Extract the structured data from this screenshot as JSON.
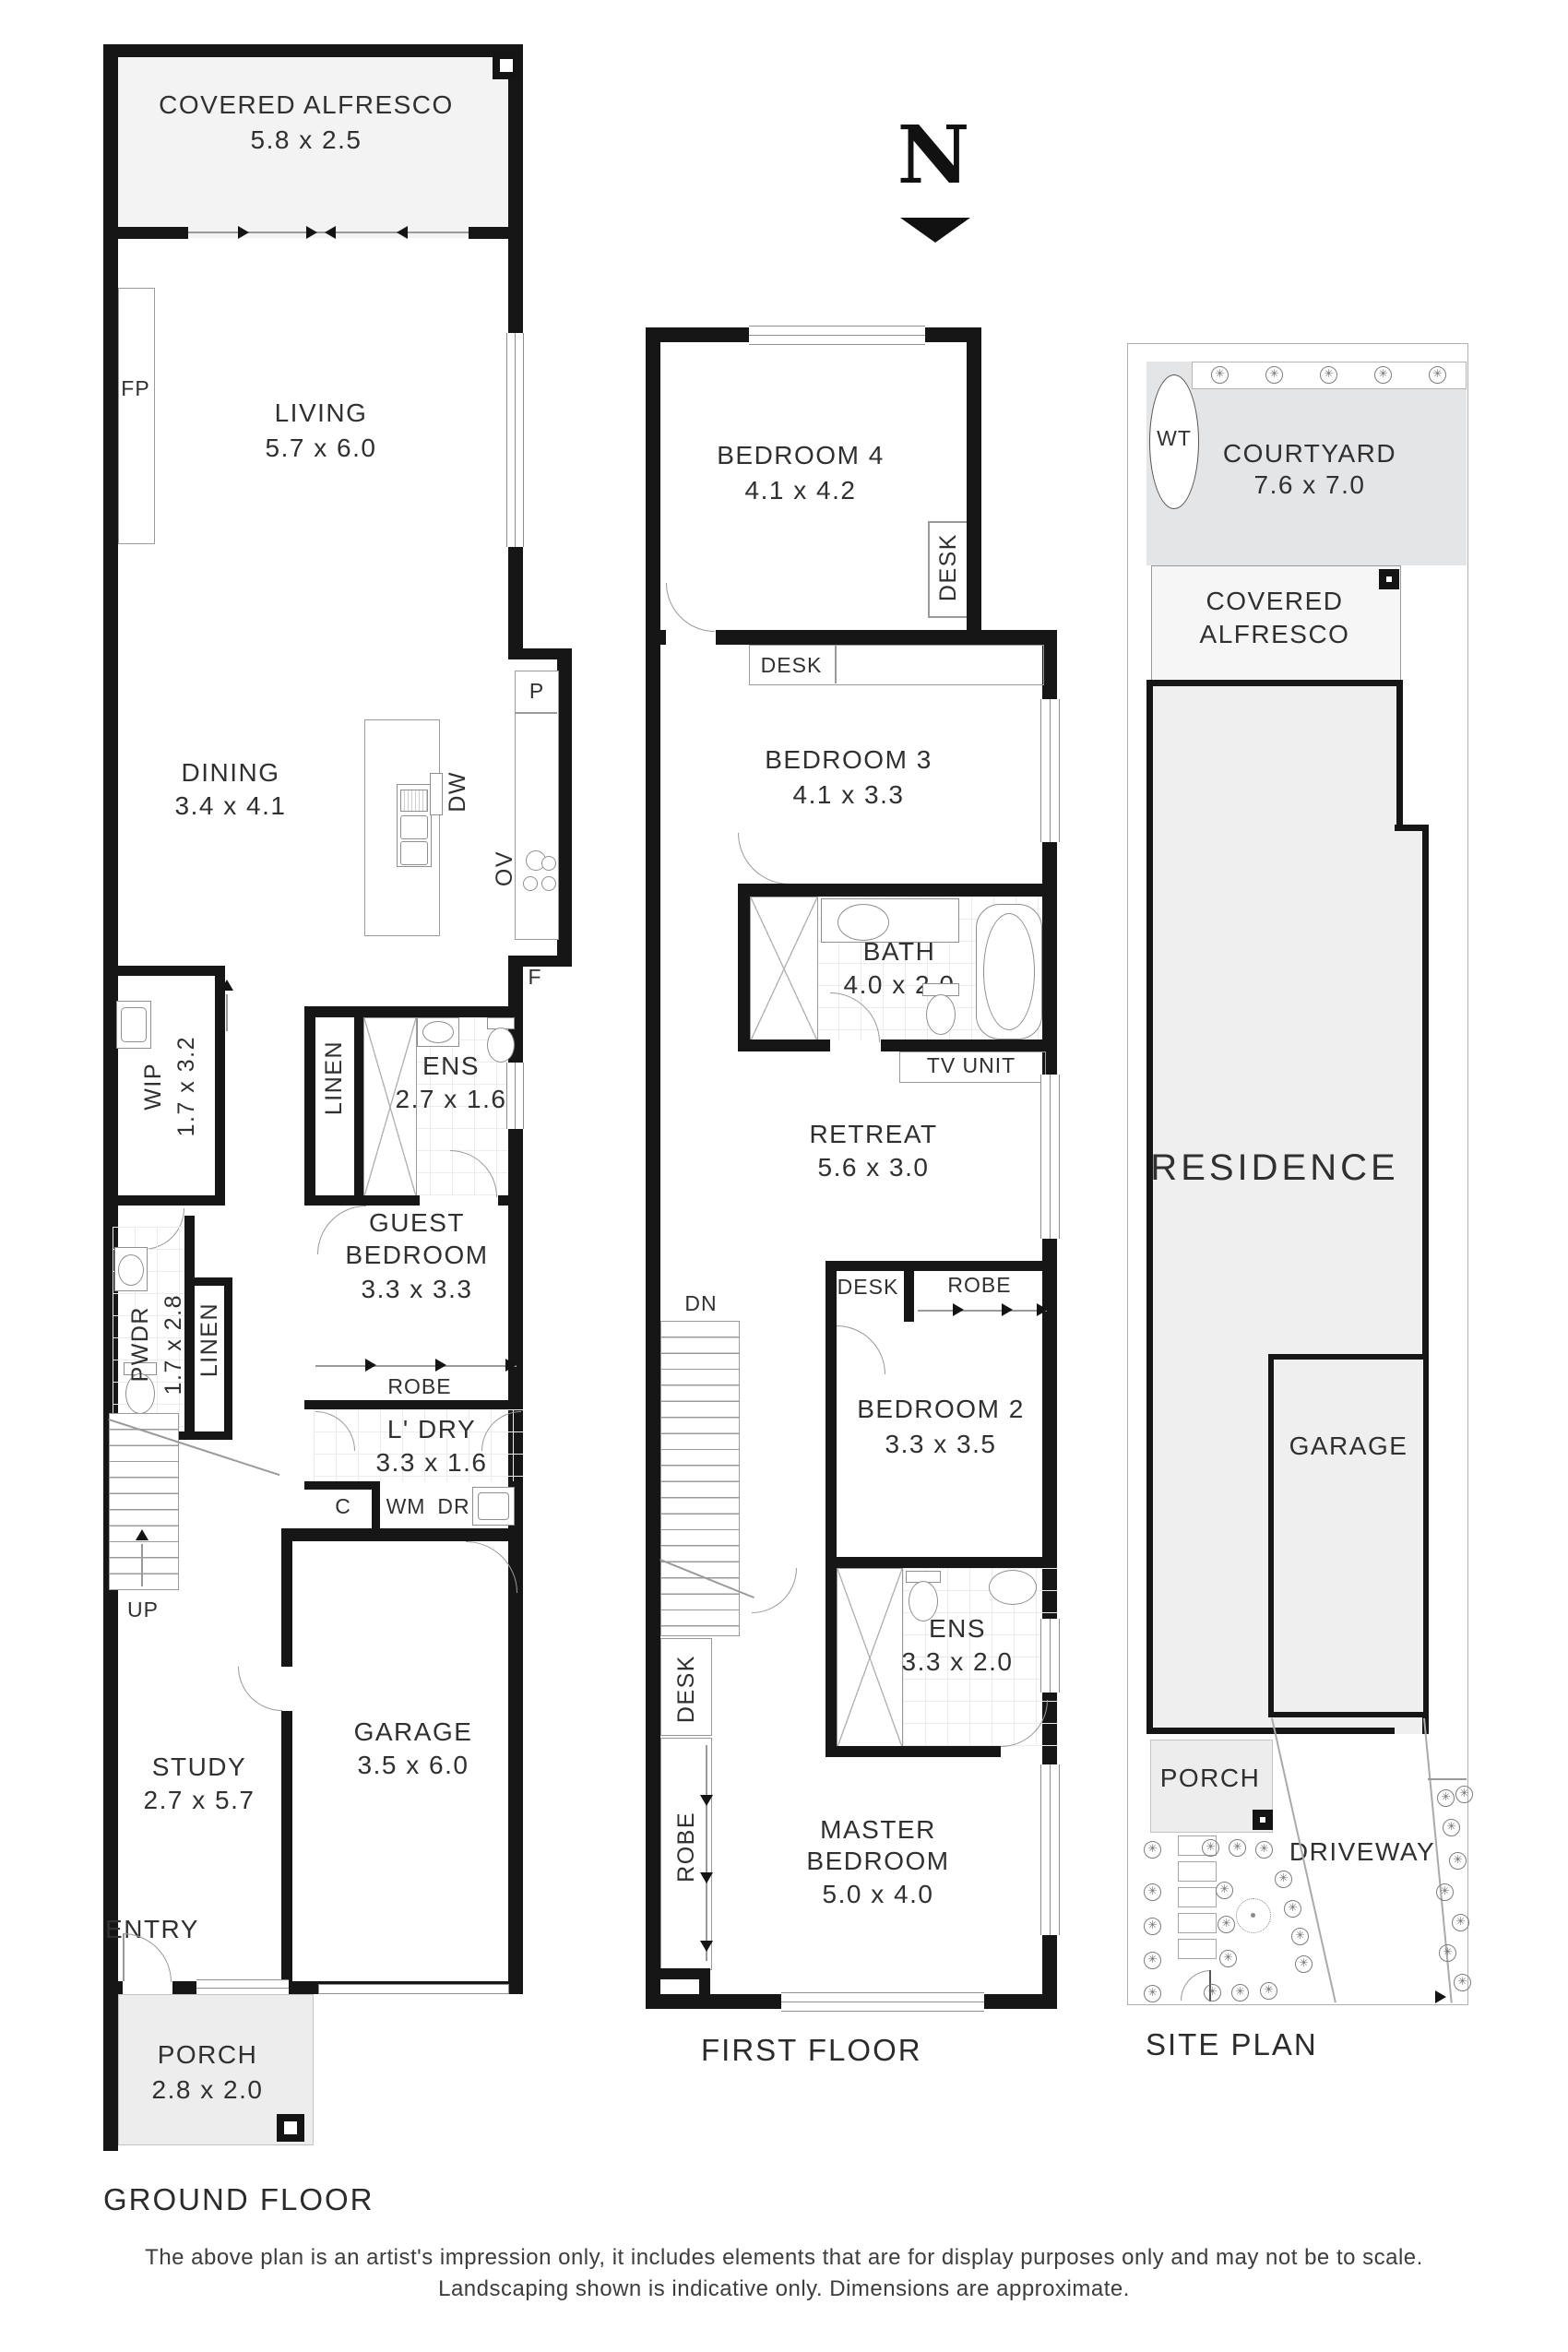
{
  "north": {
    "letter": "N"
  },
  "ground_floor": {
    "caption": "GROUND FLOOR",
    "covered_alfresco_name": "COVERED ALFRESCO",
    "covered_alfresco_dim": "5.8 x 2.5",
    "fp": "FP",
    "living_name": "LIVING",
    "living_dim": "5.7 x 6.0",
    "dining_name": "DINING",
    "dining_dim": "3.4 x 4.1",
    "dw": "DW",
    "ov": "OV",
    "pantry": "P",
    "fridge": "F",
    "wip_name": "WIP",
    "wip_dim": "1.7  x  3.2",
    "linen": "LINEN",
    "ens_name": "ENS",
    "ens_dim": "2.7 x 1.6",
    "guest_name_line1": "GUEST",
    "guest_name_line2": "BEDROOM",
    "guest_dim": "3.3 x 3.3",
    "robe": "ROBE",
    "pwdr_name": "PWDR",
    "pwdr_dim": "1.7  x  2.8",
    "ldry_name": "L' DRY",
    "ldry_dim": "3.3 x 1.6",
    "c": "C",
    "wm": "WM",
    "dr": "DR",
    "up": "UP",
    "study_name": "STUDY",
    "study_dim": "2.7 x 5.7",
    "garage_name": "GARAGE",
    "garage_dim": "3.5 x 6.0",
    "entry": "ENTRY",
    "porch_name": "PORCH",
    "porch_dim": "2.8 x 2.0"
  },
  "first_floor": {
    "caption": "FIRST FLOOR",
    "bedroom4_name": "BEDROOM 4",
    "bedroom4_dim": "4.1 x 4.2",
    "desk": "DESK",
    "bedroom3_name": "BEDROOM 3",
    "bedroom3_dim": "4.1 x 3.3",
    "bath_name": "BATH",
    "bath_dim": "4.0 x 2.0",
    "tv_unit": "TV UNIT",
    "retreat_name": "RETREAT",
    "retreat_dim": "5.6 x 3.0",
    "robe": "ROBE",
    "dn": "DN",
    "bedroom2_name": "BEDROOM 2",
    "bedroom2_dim": "3.3 x 3.5",
    "ens_name": "ENS",
    "ens_dim": "3.3 x 2.0",
    "master_name_line1": "MASTER",
    "master_name_line2": "BEDROOM",
    "master_dim": "5.0 x 4.0"
  },
  "site_plan": {
    "caption": "SITE PLAN",
    "wt": "WT",
    "courtyard_name": "COURTYARD",
    "courtyard_dim": "7.6 x 7.0",
    "alfresco_line1": "COVERED",
    "alfresco_line2": "ALFRESCO",
    "residence": "RESIDENCE",
    "garage": "GARAGE",
    "porch": "PORCH",
    "driveway": "DRIVEWAY"
  },
  "disclaimer": {
    "line1": "The above plan is an artist's impression only, it includes elements that are for display purposes only and may not be to scale.",
    "line2": "Landscaping shown is indicative only. Dimensions are approximate."
  },
  "colors": {
    "wall": "#161616",
    "thin_line": "#9a9a9a",
    "text": "#303030",
    "alfresco_fill": "#f3f3f3",
    "courtyard_fill": "#e3e5e7",
    "residence_fill": "#efefef",
    "porch_fill": "#ededed"
  }
}
